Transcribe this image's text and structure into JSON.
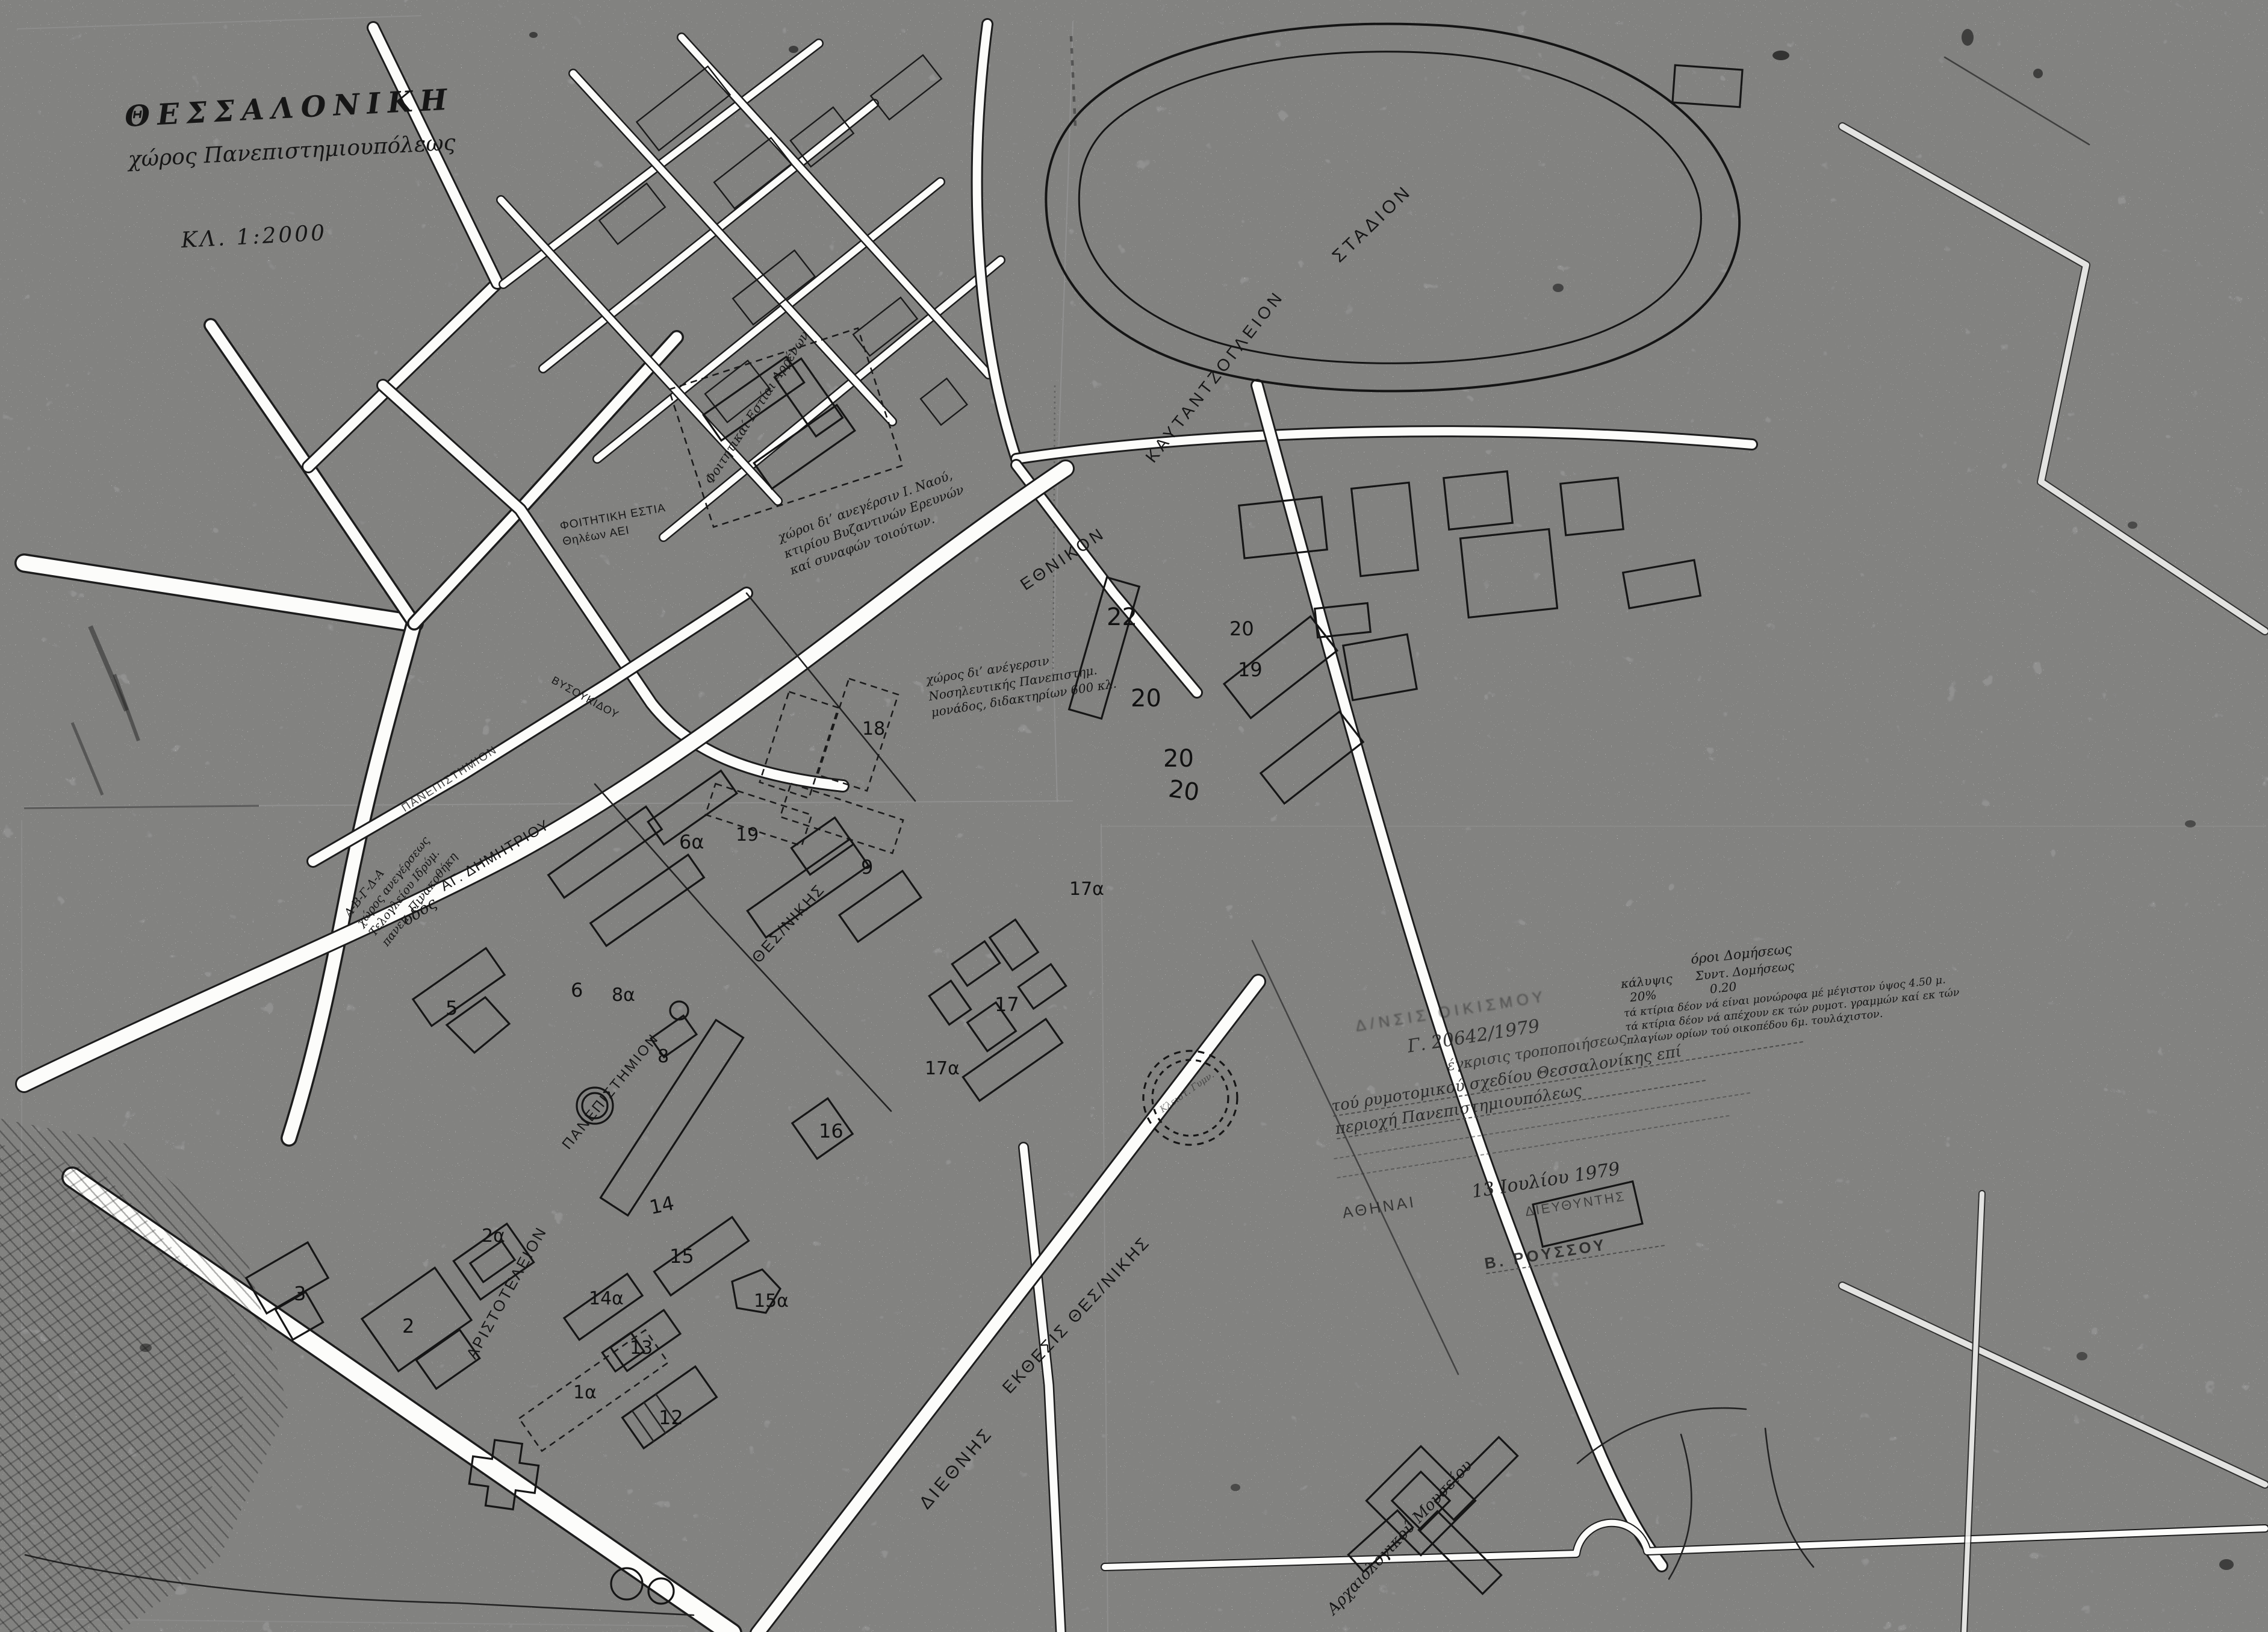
{
  "title": {
    "city": "ΘΕΣΣΑΛΟΝΙΚΗ",
    "subject": "χώρος Πανεπιστημιουπόλεως",
    "scale": "ΚΛ. 1:2000"
  },
  "places": {
    "stadium_w1": "ΕΘΝΙΚΟΝ",
    "stadium_w2": "ΚΑΥΤΑΝΤΖΟΓΛΕΙΟΝ",
    "stadium_w3": "ΣΤΑΔΙΟΝ",
    "university_w1": "ΑΡΙΣΤΟΤΕΛΕΙΟΝ",
    "university_w2": "ΠΑΝΕΠΙΣΤΗΜΙΟΝ",
    "university_w3": "ΘΕΣ/ΝΙΚΗΣ",
    "fair_w1": "ΔΙΕΘΝΗΣ",
    "fair_w2": "ΕΚΘΕΣΙΣ ΘΕΣ/ΝΙΚΗΣ",
    "museum": "Αρχαιολογικού Μουσείου",
    "gym": "Κλειστ. Γυμν."
  },
  "streets": {
    "odos_prefix": "οδός",
    "ag_dimitriou": "ΑΓ. ΔΗΜΗΤΡΙΟΥ",
    "panepistimiou": "ΠΑΝΕΠΙΣΤΗΜΙΟΝ",
    "vysoukidou": "ΒΥΣΟΥΚΙΔΟΥ"
  },
  "notes": {
    "teloglion": "Α-Β-Γ-Δ-Α\nχώρος ανεγέρσεως\nΤελογλείου Ιδρύμ.\nπανεπ. Πινακοθήκη",
    "church": "χώροι δι’ ανεγέρσιν Ι. Ναού,\nκτιρίου Βυζαντινών Ερευνών\nκαί συναφών τοιούτων.",
    "nursing": "χώρος δι’ ανέγερσιν\nΝοσηλευτικής Πανεπιστημ.\nμονάδος, διδακτηρίων 600 κλ.",
    "dorm_female": "ΦΟΙΤΗΤΙΚΗ ΕΣΤΙΑ\nΘηλέων ΑΕΙ",
    "dorm_male": "Φοιτητικαί Εστίαι Αρρένων"
  },
  "terms": {
    "heading": "όροι Δομήσεως",
    "row1": "κάλυψις      Συντ. Δομήσεως",
    "row2": "  20%              0.20",
    "rule1": "τά κτίρια δέον νά είναι μονώροφα μέ μέγιστον ύψος 4.50 μ.",
    "rule2": "τά κτίρια δέον νά απέχουν εκ τών ρυμοτ. γραμμών καί εκ τών",
    "rule3": "πλαγίων ορίων τού οικοπέδου 6μ. τουλάχιστον."
  },
  "stamp": {
    "l1": "Δ/ΝΣΙΣ ΟΙΚΙΣΜΟΥ",
    "l2": "Γ. 20642/1979",
    "l3": "έγκρισις τροποποιήσεως",
    "l4": "τού ρυμοτομικού σχεδίου Θεσσαλονίκης επί",
    "l5": "περιοχή Πανεπιστημιουπόλεως",
    "city": "ΑΘΗΝΑΙ",
    "date": "13 Ιουλίου 1979",
    "role": "ΔΙΕΥΘΥΝΤΗΣ",
    "signature": "Β. ΡΟΥΣΣΟΥ"
  },
  "numbers": [
    {
      "t": "22"
    },
    {
      "t": "20"
    },
    {
      "t": "19"
    },
    {
      "t": "20"
    },
    {
      "t": "20"
    },
    {
      "t": "20"
    },
    {
      "t": "18"
    },
    {
      "t": "19"
    },
    {
      "t": "6α"
    },
    {
      "t": "6"
    },
    {
      "t": "8α"
    },
    {
      "t": "8"
    },
    {
      "t": "9"
    },
    {
      "t": "5"
    },
    {
      "t": "16"
    },
    {
      "t": "17"
    },
    {
      "t": "17α"
    },
    {
      "t": "17α"
    },
    {
      "t": "14"
    },
    {
      "t": "15"
    },
    {
      "t": "15α"
    },
    {
      "t": "14α"
    },
    {
      "t": "2α"
    },
    {
      "t": "2"
    },
    {
      "t": "3"
    },
    {
      "t": "1α"
    },
    {
      "t": "13"
    },
    {
      "t": "12"
    }
  ]
}
